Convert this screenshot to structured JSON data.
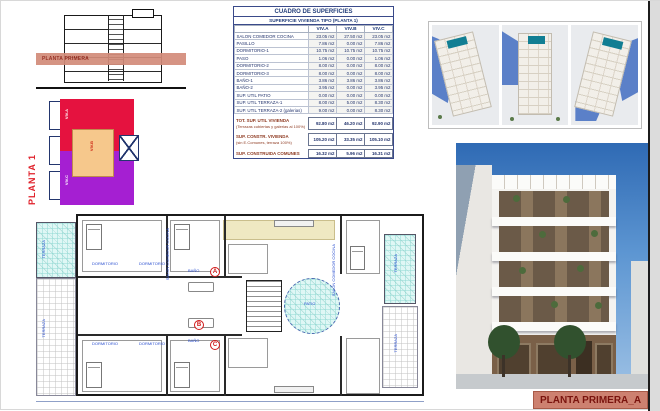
{
  "sheet": {
    "footer_label": "PLANTA PRIMERA_A"
  },
  "section_drawing": {
    "band_label": "PLANTA PRIMERA"
  },
  "key_plan": {
    "title": "PLANTA 1",
    "zones": [
      {
        "label": "VIV.A",
        "color": "#e5123f"
      },
      {
        "label": "VIV.B",
        "color": "#f6c88c"
      },
      {
        "label": "VIV.C",
        "color": "#a51fd2"
      }
    ]
  },
  "table": {
    "title": "CUADRO DE SUPERFICIES",
    "subtitle": "SUPERFICIE VIVIENDA TIPO (PLANTA 1)",
    "columns": [
      "VIV.A",
      "VIV.B",
      "VIV.C"
    ],
    "rows": [
      {
        "label": "SALON COMEDOR COCINA",
        "a": "23.05 m2",
        "b": "27.50 m2",
        "c": "23.05 m2"
      },
      {
        "label": "PASILLO",
        "a": "7.86 m2",
        "b": "0.00 m2",
        "c": "7.86 m2"
      },
      {
        "label": "DORMITORIO-1",
        "a": "10.75 m2",
        "b": "10.75 m2",
        "c": "10.75 m2"
      },
      {
        "label": "PASO",
        "a": "1.06 m2",
        "b": "0.00 m2",
        "c": "1.06 m2"
      },
      {
        "label": "DORMITORIO-2",
        "a": "8.00 m2",
        "b": "0.00 m2",
        "c": "8.00 m2"
      },
      {
        "label": "DORMITORIO-3",
        "a": "8.00 m2",
        "b": "0.00 m2",
        "c": "8.00 m2"
      },
      {
        "label": "BAÑO-1",
        "a": "3.86 m2",
        "b": "3.86 m2",
        "c": "3.86 m2"
      },
      {
        "label": "BAÑO-2",
        "a": "3.95 m2",
        "b": "0.00 m2",
        "c": "3.95 m2"
      },
      {
        "label": "SUP. UTIL PATIO",
        "a": "0.00 m2",
        "b": "0.00 m2",
        "c": "0.00 m2"
      },
      {
        "label": "SUP. UTIL TERRAZA-1",
        "a": "8.00 m2",
        "b": "5.00 m2",
        "c": "8.30 m2"
      },
      {
        "label": "SUP. UTIL TERRAZA-2 (galerias)",
        "a": "9.00 m2",
        "b": "0.00 m2",
        "c": "8.30 m2"
      }
    ],
    "totals": [
      {
        "label": "TOT. SUP. UTIL VIVIENDA",
        "sublabel": "(Terrazas cubiertas y galerias al 100%)",
        "a": "92.80 m2",
        "b": "46.20 m2",
        "c": "92.90 m2"
      },
      {
        "label": "SUP. CONSTR. VIVIENDA",
        "sublabel": "(sin E.Comunes, terraza 100%)",
        "a": "105.20 m2",
        "b": "33.35 m2",
        "c": "105.10 m2"
      },
      {
        "label": "SUP. CONSTRUIDA COMUNES",
        "sublabel": "",
        "a": "16.32 m2",
        "b": "5.96 m2",
        "c": "16.31 m2"
      }
    ]
  },
  "plan": {
    "labels": [
      {
        "text": "TERRAZA",
        "x": 6,
        "y": 26,
        "v": 1
      },
      {
        "text": "TERRAZA",
        "x": 6,
        "y": 105,
        "v": 1
      },
      {
        "text": "DORMITORIO",
        "x": 56,
        "y": 48,
        "v": 0
      },
      {
        "text": "DORMITORIO",
        "x": 103,
        "y": 48,
        "v": 0
      },
      {
        "text": "DORMITORIO",
        "x": 56,
        "y": 128,
        "v": 0
      },
      {
        "text": "DORMITORIO",
        "x": 103,
        "y": 128,
        "v": 0
      },
      {
        "text": "SALON COMEDOR COCINA",
        "x": 130,
        "y": 14,
        "v": 1
      },
      {
        "text": "BAÑO",
        "x": 152,
        "y": 55,
        "v": 0
      },
      {
        "text": "BAÑO",
        "x": 152,
        "y": 125,
        "v": 0
      },
      {
        "text": "PATIO",
        "x": 268,
        "y": 88,
        "v": 0
      },
      {
        "text": "SALON COMEDOR COCINA",
        "x": 296,
        "y": 30,
        "v": 1
      },
      {
        "text": "TERRAZA",
        "x": 358,
        "y": 40,
        "v": 1
      },
      {
        "text": "TERRAZA",
        "x": 358,
        "y": 120,
        "v": 1
      }
    ],
    "apartments": [
      {
        "letter": "A",
        "x": 174,
        "y": 53
      },
      {
        "letter": "B",
        "x": 158,
        "y": 106
      },
      {
        "letter": "C",
        "x": 174,
        "y": 126
      }
    ]
  },
  "colors": {
    "accent_salmon": "#cd8170",
    "navy": "#223d7a",
    "section_red": "#8e3a21",
    "zone_a_red": "#e5123f",
    "zone_b_orange": "#f6c88c",
    "zone_c_purple": "#a51fd2",
    "terrace_cyan": "#dff7f5",
    "sky_blue": "#2f6ab4",
    "pool_teal": "#117e93"
  }
}
